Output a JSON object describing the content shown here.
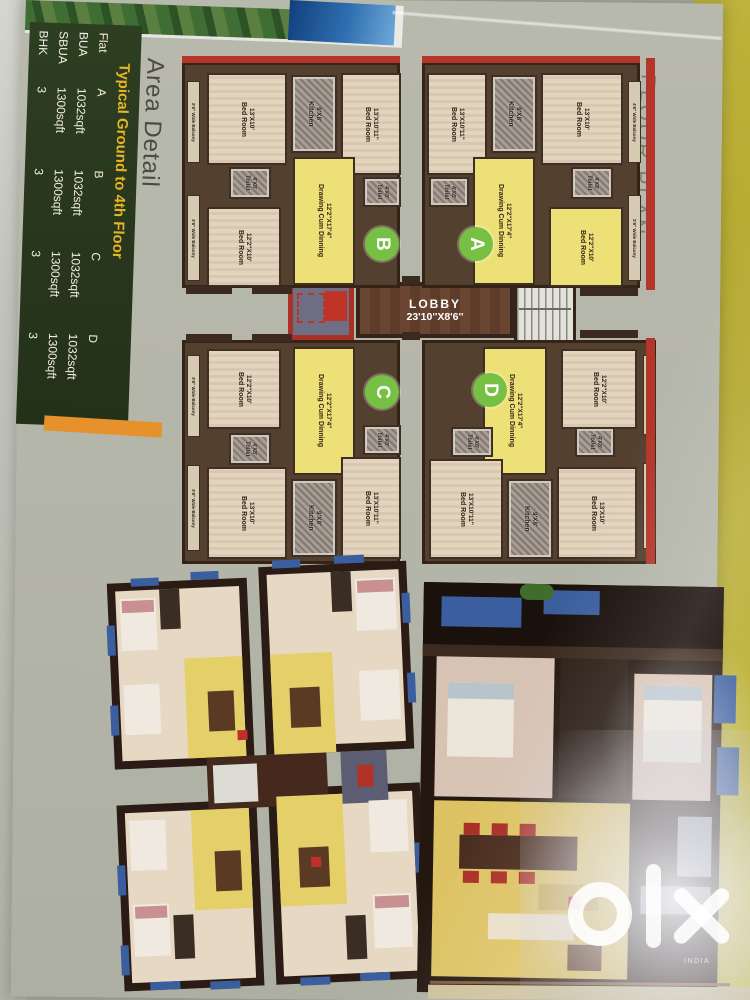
{
  "side_panel": {
    "title": "Area Detail",
    "heading": "Typical Ground to 4th Floor",
    "table": {
      "header": [
        "Flat",
        "A",
        "B",
        "C",
        "D"
      ],
      "rows": [
        [
          "BUA",
          "1032sqft",
          "1032sqft",
          "1032sqft",
          "1032sqft"
        ],
        [
          "SBUA",
          "1300sqft",
          "1300sqft",
          "1300sqft",
          "1300sqft"
        ],
        [
          "BHK",
          "3",
          "3",
          "3",
          "3"
        ]
      ]
    }
  },
  "floor_plan": {
    "title": "FLOOR PLAN",
    "lobby": {
      "name": "LOBBY",
      "dims": "23'10''X8'6''"
    },
    "room_types": {
      "bed_a": {
        "name": "Bed Room",
        "dims": "13'X10'"
      },
      "bed_b": {
        "name": "Bed Room",
        "dims": "13'X10'11''"
      },
      "bed_c": {
        "name": "Bed Room",
        "dims": "12'2''X10'"
      },
      "kitchen": {
        "name": "Kitchen",
        "dims": "9'X8'"
      },
      "toilet": {
        "name": "Toilet",
        "dims": "4'X8'"
      },
      "drawing": {
        "name": "Drawing Cum Dinning",
        "dims": "12'2''X17'4''"
      }
    },
    "units": [
      {
        "letter": "B"
      },
      {
        "letter": "A"
      },
      {
        "letter": "C"
      },
      {
        "letter": "D"
      }
    ],
    "balcony_labels": [
      "2'6'' Wide Balcony",
      "3'6'' Wide Balcony",
      "4'6'' Wide Balcony"
    ]
  },
  "colors": {
    "accent_red": "#b43529",
    "unit_green": "#76c043",
    "panel_green": "#2a3a1e",
    "panel_gold": "#e7b427",
    "orange_strip": "#e6912b"
  },
  "watermark": {
    "logo": "olx",
    "sub": "INDIA"
  }
}
